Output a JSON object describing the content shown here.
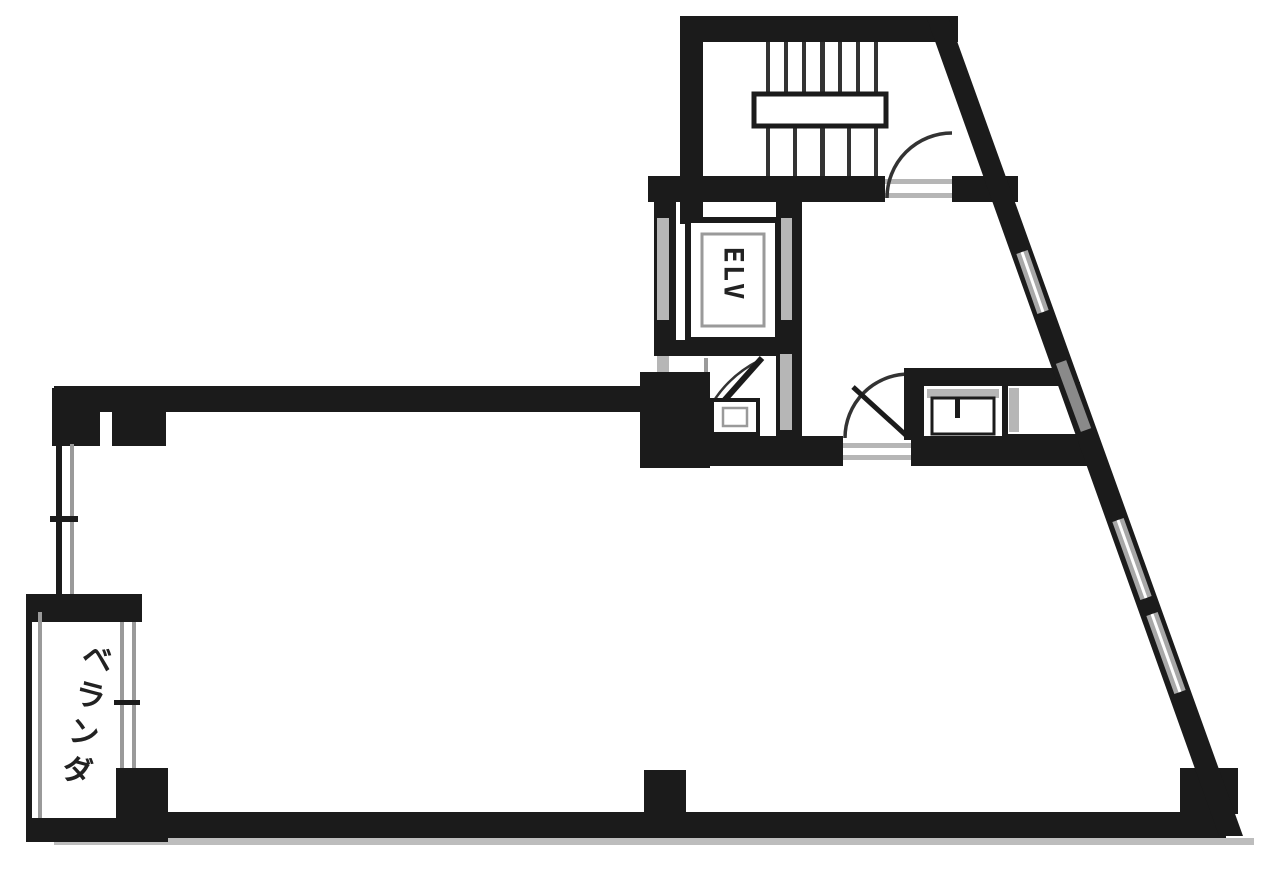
{
  "labels": {
    "elevator": "ELV",
    "balcony": "ベランダ"
  },
  "colors": {
    "wall": "#1b1b1b",
    "line_mid": "#333333",
    "window_gray": "#9a9a9a",
    "jamb_gray": "#b6b6b6",
    "shadow_gray": "#bdbdbd",
    "background": "#ffffff"
  }
}
